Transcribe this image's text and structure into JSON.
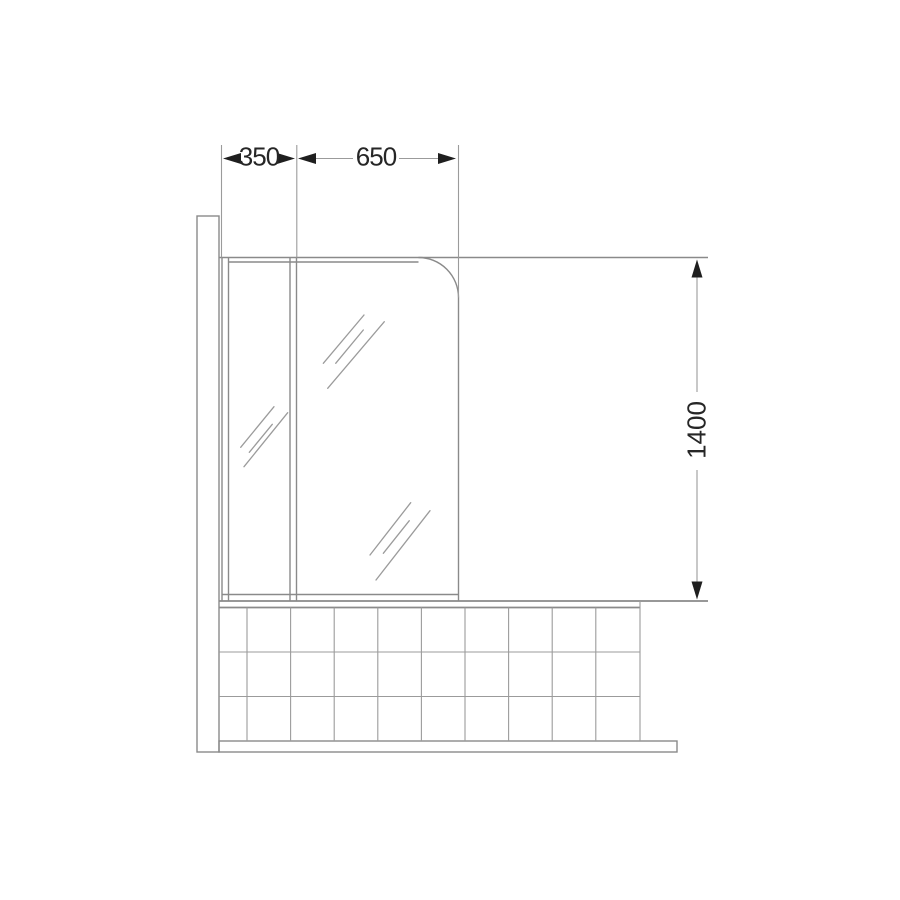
{
  "diagram": {
    "dimension_labels": {
      "left_panel_width": "350",
      "right_panel_width": "650",
      "screen_height": "1400"
    },
    "colors": {
      "background": "#ffffff",
      "line": "#9b9b9b",
      "frame_line": "#8a8a8a",
      "text": "#262626",
      "arrow": "#1f1f1f"
    }
  }
}
